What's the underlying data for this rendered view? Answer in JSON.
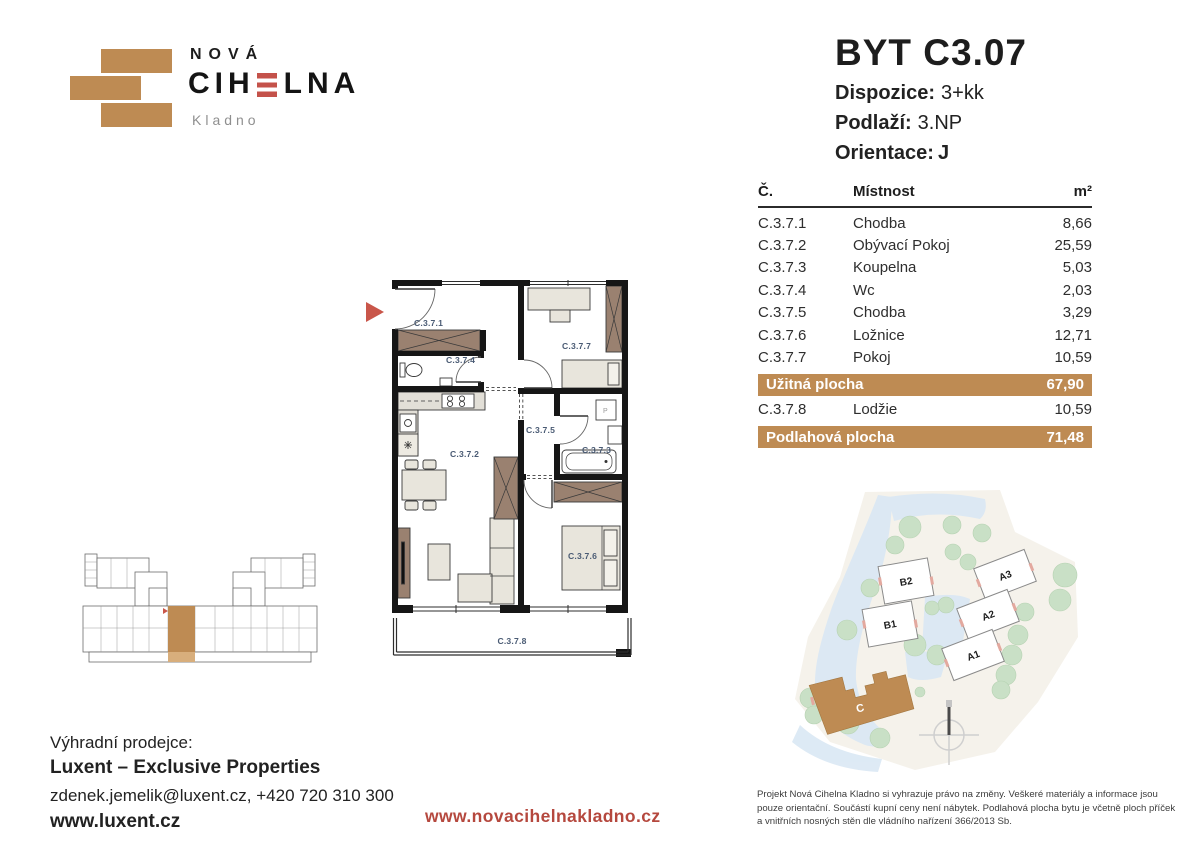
{
  "logo": {
    "line1": "NOVÁ",
    "brand_pre": "CIH",
    "brand_post": "LNA",
    "city": "Kladno"
  },
  "header": {
    "title": "BYT C3.07",
    "specs": [
      {
        "label": "Dispozice:",
        "value": "3+kk"
      },
      {
        "label": "Podlaží:",
        "value": "3.NP"
      },
      {
        "label": "Orientace:",
        "value": "J"
      }
    ]
  },
  "area_table": {
    "col_number": "Č.",
    "col_room": "Místnost",
    "col_area": "m²",
    "rows": [
      {
        "id": "C.3.7.1",
        "room": "Chodba",
        "area": "8,66"
      },
      {
        "id": "C.3.7.2",
        "room": "Obývací Pokoj",
        "area": "25,59"
      },
      {
        "id": "C.3.7.3",
        "room": "Koupelna",
        "area": "5,03"
      },
      {
        "id": "C.3.7.4",
        "room": "Wc",
        "area": "2,03"
      },
      {
        "id": "C.3.7.5",
        "room": "Chodba",
        "area": "3,29"
      },
      {
        "id": "C.3.7.6",
        "room": "Ložnice",
        "area": "12,71"
      },
      {
        "id": "C.3.7.7",
        "room": "Pokoj",
        "area": "10,59"
      }
    ],
    "usable": {
      "label": "Užitná plocha",
      "area": "67,90"
    },
    "extra_row": {
      "id": "C.3.7.8",
      "room": "Lodžie",
      "area": "10,59"
    },
    "total": {
      "label": "Podlahová plocha",
      "area": "71,48"
    }
  },
  "floorplan": {
    "labels": {
      "hall": "C.3.7.1",
      "living": "C.3.7.2",
      "bath": "C.3.7.3",
      "wc": "C.3.7.4",
      "corridor": "C.3.7.5",
      "bedroom": "C.3.7.6",
      "room": "C.3.7.7",
      "loggia": "C.3.7.8"
    }
  },
  "sitemap": {
    "buildings": [
      "B2",
      "B1",
      "A3",
      "A2",
      "A1"
    ],
    "highlighted": "C"
  },
  "footer": {
    "seller_label": "Výhradní prodejce:",
    "seller_name": "Luxent – Exclusive Properties",
    "seller_contact": "zdenek.jemelik@luxent.cz, +420 720 310 300",
    "seller_web": "www.luxent.cz",
    "project_web": "www.novacihelnakladno.cz",
    "disclaimer": "Projekt Nová Cihelna Kladno si vyhrazuje právo na změny. Veškeré materiály a informace jsou pouze orientační. Součástí kupní ceny není nábytek. Podlahová plocha bytu je včetně ploch příček a vnitřních nosných stěn dle vládního nařízení 366/2013 Sb."
  },
  "colors": {
    "brick": "#BE8B53",
    "accent_red": "#B5483E",
    "label_blue": "#4A5B74"
  }
}
